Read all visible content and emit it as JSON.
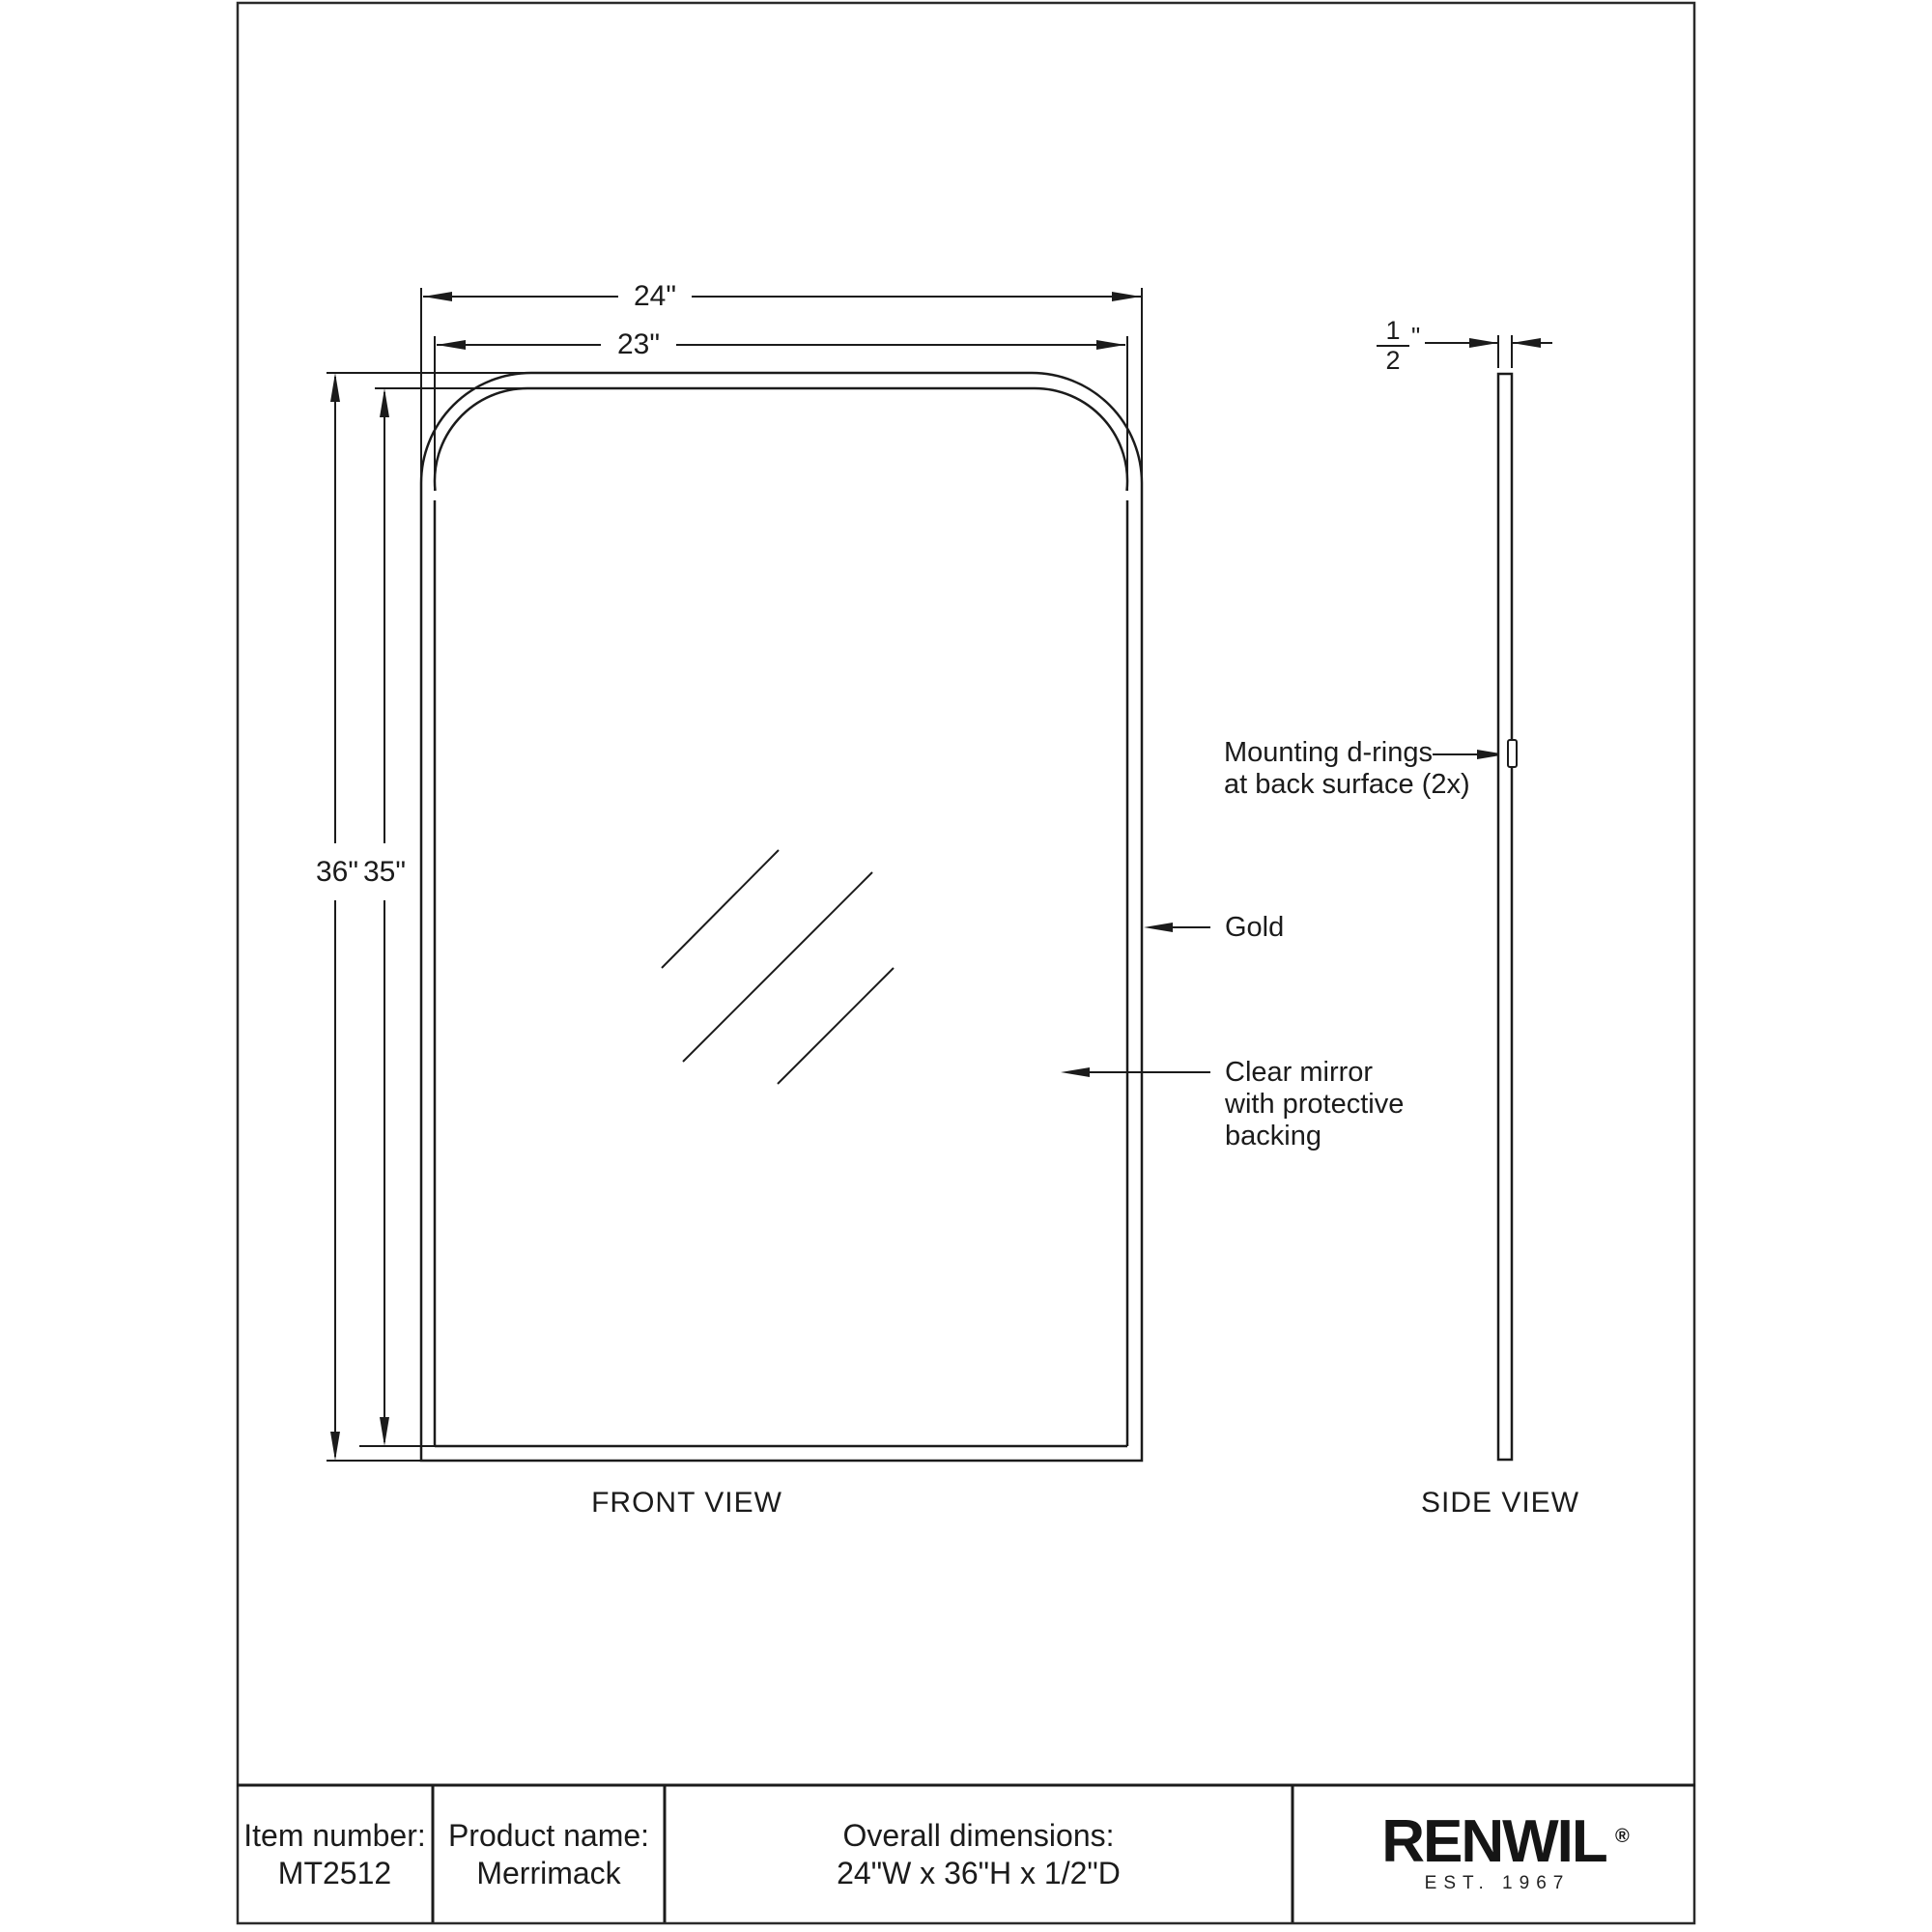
{
  "front_view": {
    "label": "FRONT VIEW",
    "dims": {
      "overall_width": "24\"",
      "inner_width": "23\"",
      "overall_height": "36\"",
      "inner_height": "35\""
    },
    "annotations": {
      "mounting_line1": "Mounting d-rings",
      "mounting_line2": "at back surface (2x)",
      "finish": "Gold",
      "mirror_line1": "Clear mirror",
      "mirror_line2": "with protective",
      "mirror_line3": "backing"
    }
  },
  "side_view": {
    "label": "SIDE VIEW",
    "depth_fraction_numerator": "1",
    "depth_fraction_denominator": "2",
    "depth_unit": "\""
  },
  "title_block": {
    "item_label": "Item number:",
    "item_value": "MT2512",
    "product_label": "Product name:",
    "product_value": "Merrimack",
    "dims_label": "Overall dimensions:",
    "dims_value": "24\"W x 36\"H x 1/2\"D",
    "brand_name": "RENWIL",
    "brand_registered": "®",
    "brand_est": "EST. 1967"
  }
}
